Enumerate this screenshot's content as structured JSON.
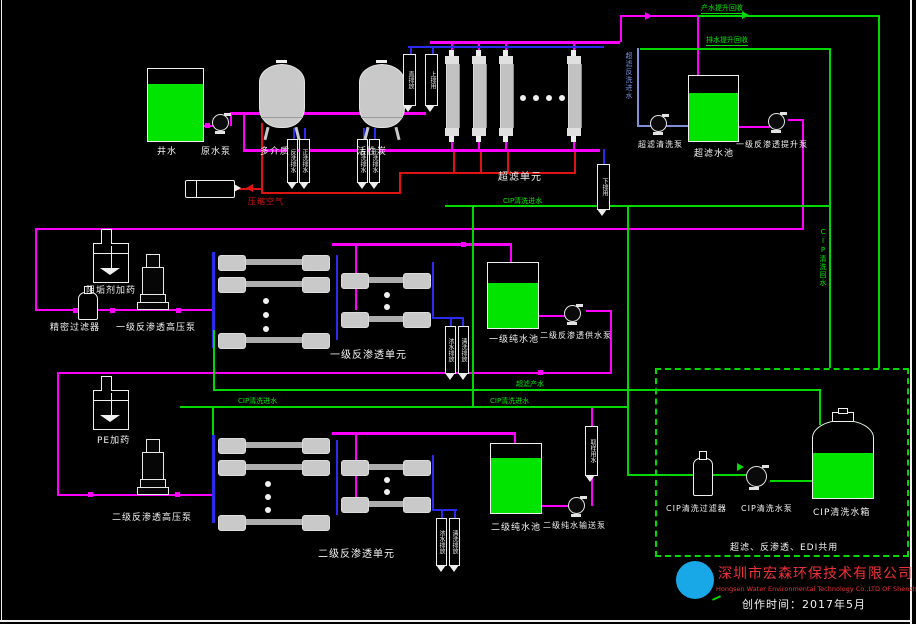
{
  "diagram": {
    "pretreatment": {
      "well_tank": "井水",
      "raw_water_pump": "原水泵",
      "multimedia_filter": "多介质",
      "activated_carbon": "活性炭",
      "compressed_air": "压缩空气"
    },
    "uf": {
      "unit": "超滤单元",
      "cip_inlet": "CIP清洗进水",
      "backwash_inlet": "超滤反洗进水",
      "clean_pump": "超滤清洗泵",
      "water_tank": "超滤水池",
      "ro1_lift_pump": "一级反渗透提升泵",
      "product_return": "产水提升回收",
      "drain_return": "排水提升回收",
      "product_line": "超滤产水"
    },
    "ro1": {
      "antiscalant": "阻垢剂加药",
      "precision_filter": "精密过滤器",
      "hp_pump": "一级反渗透高压泵",
      "unit": "一级反渗透单元",
      "pure_tank": "一级纯水池",
      "ro2_feed_pump": "二级反渗透供水泵",
      "cip_inlet": "CIP清洗进水"
    },
    "ro2": {
      "pe_dosing": "PE加药",
      "hp_pump": "二级反渗透高压泵",
      "unit": "二级反渗透单元",
      "pure_tank": "二级纯水池",
      "transfer_pump": "二级纯水输送泵",
      "cip_inlet": "CIP清洗进水"
    },
    "cip": {
      "filter": "CIP清洗过滤器",
      "pump": "CIP清洗水泵",
      "tank": "CIP清洗水箱",
      "shared_note": "超滤、反渗透、EDI共用",
      "return_line": "CIP清洗回水"
    },
    "tags": {
      "t_direct": "直排放",
      "t_upper": "上排用",
      "t_lower": "下排用",
      "t_backwash": "反洗排水",
      "t_rinse": "正洗排水",
      "t_conc": "浓水排放",
      "t_flush": "清洗排放",
      "t_sample": "取样用水"
    },
    "title_block": {
      "company_cn": "深圳市宏森环保技术有限公司",
      "company_en": "Hongsen Water Environmental Technology Co.,LTD OF Shenzhen",
      "date": "创作时间：2017年5月"
    },
    "colors": {
      "line_product": "#FF00FF",
      "line_cip": "#00D800",
      "line_drain": "#DE1414",
      "line_backwash": "#2B2BEF",
      "tank_fill": "#00E400",
      "brand_red": "#F03038",
      "logo_blue": "#18A8E8"
    }
  }
}
